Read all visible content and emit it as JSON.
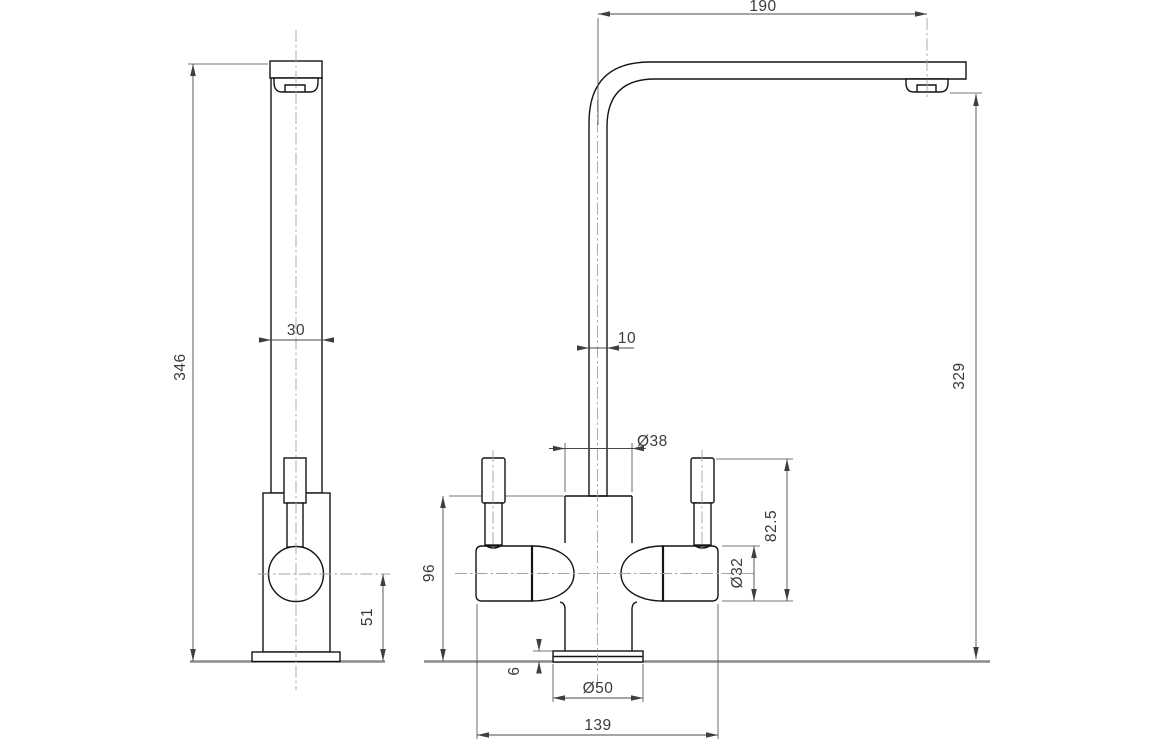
{
  "drawing": {
    "type": "technical-orthographic-drawing",
    "subject": "kitchen mixer tap, side view and front view with dimensions (mm)",
    "views": {
      "side": "side elevation",
      "front": "front elevation"
    },
    "dimensions": {
      "spout_reach": "190",
      "overall_height": "346",
      "spout_depth": "30",
      "spout_thickness": "10",
      "spout_outlet_height": "329",
      "body_diameter": "Ø38",
      "handle_top_height": "82.5",
      "body_height": "96",
      "valve_diameter": "Ø32",
      "handle_center_height": "51",
      "flange_thickness": "6",
      "flange_diameter": "Ø50",
      "overall_width": "139"
    }
  }
}
